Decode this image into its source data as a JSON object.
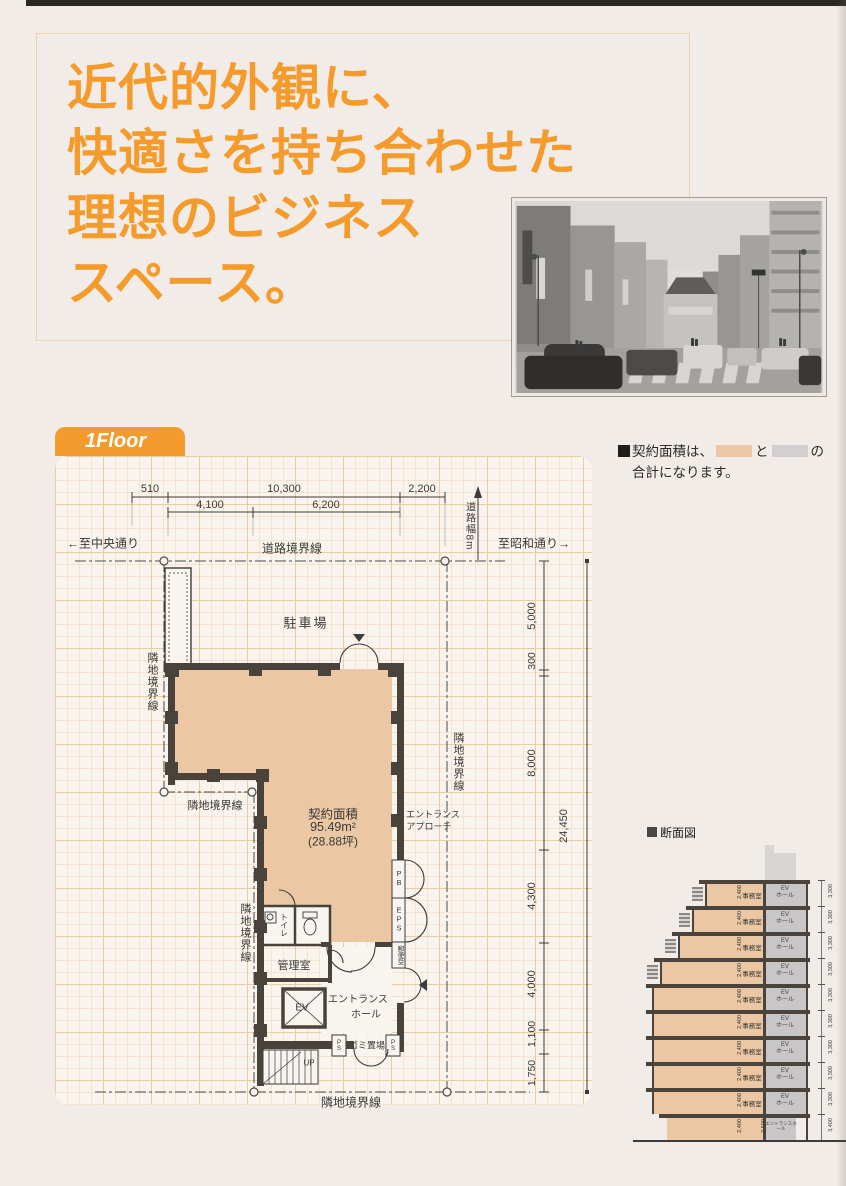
{
  "header": {
    "headline_lines": [
      "近代的外観に、",
      "快適さを持ち合わせた",
      "理想のビジネス",
      "スペース。"
    ]
  },
  "floor_tab": {
    "label": "1Floor"
  },
  "area_note": {
    "prefix": "契約面積は、",
    "connector": "と",
    "suffix": "の",
    "line2": "合計になります。"
  },
  "plan": {
    "dims": {
      "d510": "510",
      "d10300": "10,300",
      "d2200": "2,200",
      "d4100": "4,100",
      "d6200": "6,200",
      "d5000": "5,000",
      "d300": "300",
      "d8000": "8,000",
      "d4300": "4,300",
      "d4000": "4,000",
      "d1100": "1,100",
      "d1750": "1,750",
      "total": "24,450",
      "road_width": "道路幅8m"
    },
    "streets": {
      "to_chuo": "←至中央通り",
      "to_showa": "至昭和通り→"
    },
    "boundaries": {
      "road": "道路境界線",
      "adjacent": "隣地境界線"
    },
    "labels": {
      "parking": "駐車場",
      "area_title": "契約面積",
      "area_m2": "95.49m²",
      "area_tsubo": "(28.88坪)",
      "approach1": "エントランス",
      "approach2": "アプローチ",
      "pb": "PB",
      "eps": "EPS",
      "mail": "郵便受",
      "toilet": "トイレ",
      "manager": "管理室",
      "ev": "EV",
      "hall1": "エントランス",
      "hall2": "ホール",
      "garbage": "ゴミ置場",
      "ps": "PS",
      "up": "UP"
    }
  },
  "section": {
    "title": "断面図",
    "office": "事務室",
    "ev_line1": "EV",
    "ev_line2": "ホール",
    "ceiling": "2,400",
    "floor_pitch": "3,300",
    "gf_ceiling": "2,500",
    "gf_pitch": "3,400",
    "gf_hall": "エントランスホール",
    "office_floor_count": 9
  },
  "colors": {
    "accent_orange": "#f49b2e",
    "plan_tan": "#ebc8a3",
    "section_gray": "#c9c6c7",
    "wall_dark": "#4a433b",
    "note_gray_swatch": "#d2cfd0"
  }
}
